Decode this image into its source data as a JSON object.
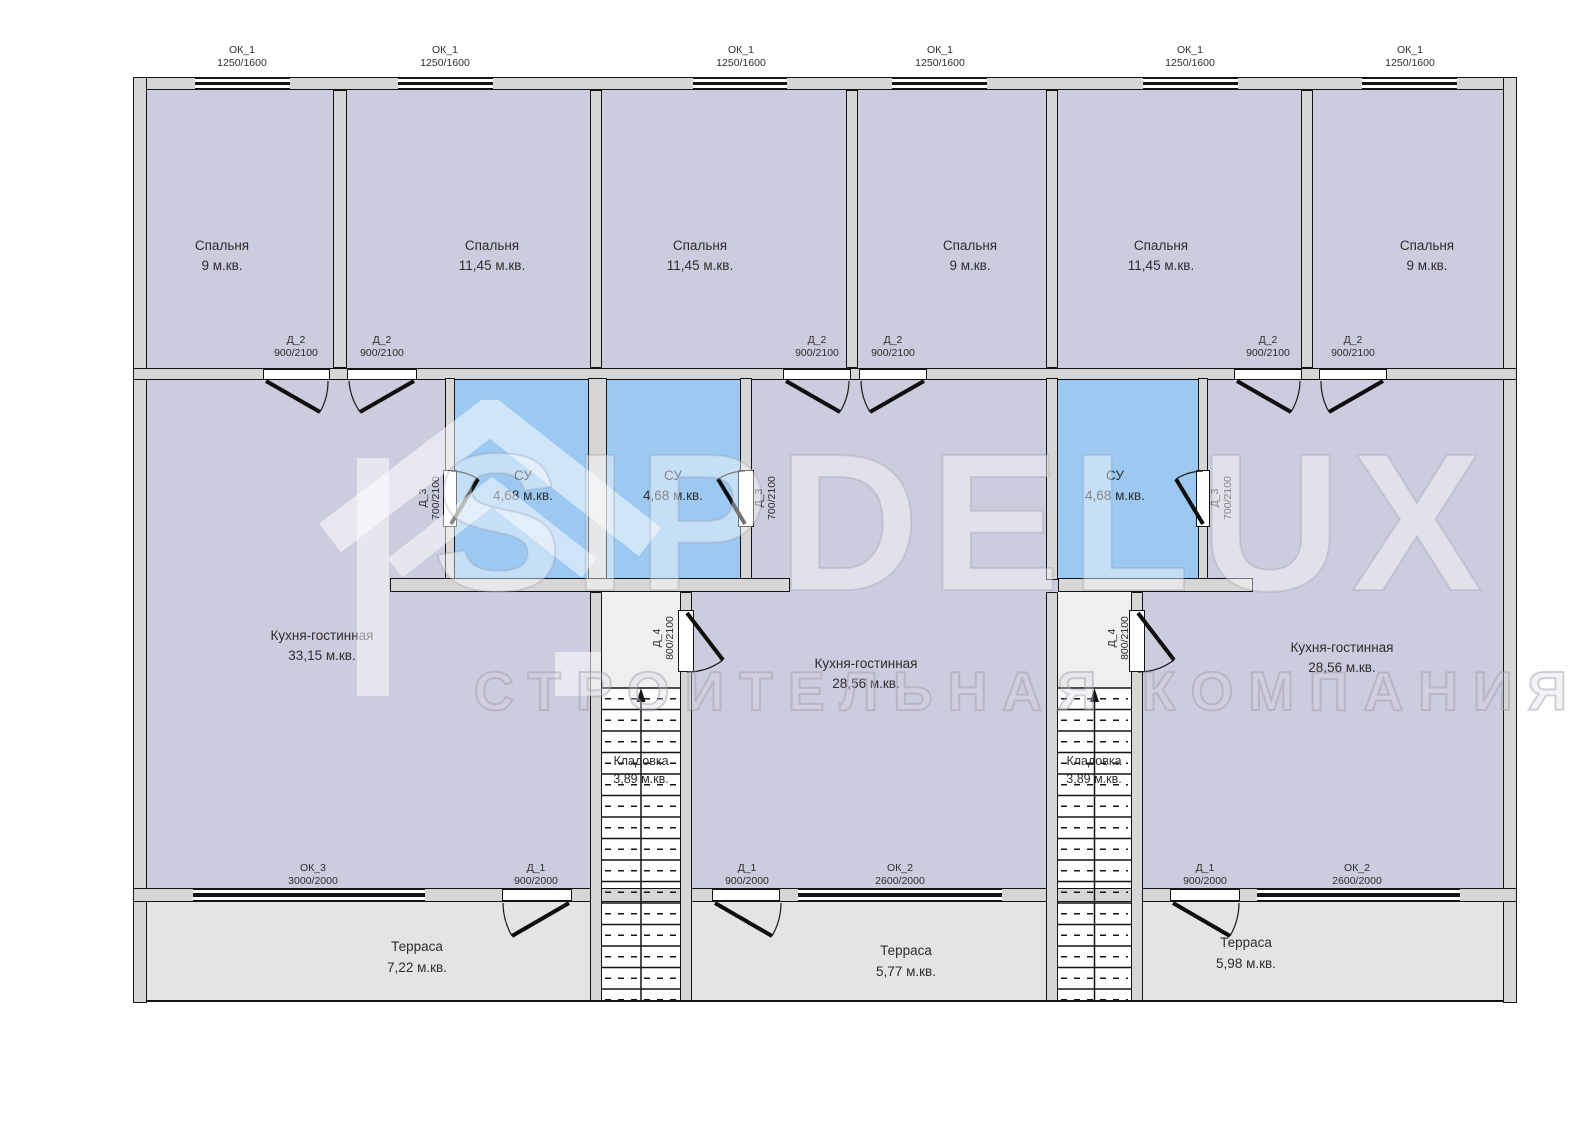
{
  "watermark": {
    "brand": "SIPDELUX",
    "tagline": "СТРОИТЕЛЬНАЯ КОМПАНИЯ"
  },
  "units": [
    {
      "bedrooms": [
        {
          "name": "Спальня",
          "area": "9 м.кв."
        },
        {
          "name": "Спальня",
          "area": "11,45 м.кв."
        }
      ],
      "bathroom": {
        "name": "СУ",
        "area": "4,68 м.кв."
      },
      "kitchen": {
        "name": "Кухня-гостинная",
        "area": "33,15 м.кв."
      },
      "terrace": {
        "name": "Терраса",
        "area": "7,22 м.кв."
      }
    },
    {
      "bedrooms": [
        {
          "name": "Спальня",
          "area": "11,45 м.кв."
        },
        {
          "name": "Спальня",
          "area": "9 м.кв."
        }
      ],
      "bathroom": {
        "name": "СУ",
        "area": "4,68 м.кв."
      },
      "kitchen": {
        "name": "Кухня-гостинная",
        "area": "28,56 м.кв."
      },
      "storage": {
        "name": "Кладовка",
        "area": "3,89 м.кв."
      },
      "terrace": {
        "name": "Терраса",
        "area": "5,77 м.кв."
      }
    },
    {
      "bedrooms": [
        {
          "name": "Спальня",
          "area": "11,45 м.кв."
        },
        {
          "name": "Спальня",
          "area": "9 м.кв."
        }
      ],
      "bathroom": {
        "name": "СУ",
        "area": "4,68 м.кв."
      },
      "kitchen": {
        "name": "Кухня-гостинная",
        "area": "28,56 м.кв."
      },
      "storage": {
        "name": "Кладовка",
        "area": "3,89 м.кв."
      },
      "terrace": {
        "name": "Терраса",
        "area": "5,98 м.кв."
      }
    }
  ],
  "openings": {
    "ok1": {
      "name": "ОК_1",
      "size": "1250/1600"
    },
    "ok2": {
      "name": "ОК_2",
      "size": "2600/2000"
    },
    "ok3": {
      "name": "ОК_3",
      "size": "3000/2000"
    },
    "d1": {
      "name": "Д_1",
      "size": "900/2000"
    },
    "d2": {
      "name": "Д_2",
      "size": "900/2100"
    },
    "d3": {
      "name": "Д_3",
      "size": "700/2100"
    },
    "d4": {
      "name": "Д_4",
      "size": "800/2100"
    }
  },
  "colors": {
    "room_fill": "#ccccdf",
    "bathroom_fill": "#9cc9f1",
    "terrace_fill": "#e4e4e4",
    "wall_fill": "#d6d6d6",
    "line": "#141414"
  }
}
